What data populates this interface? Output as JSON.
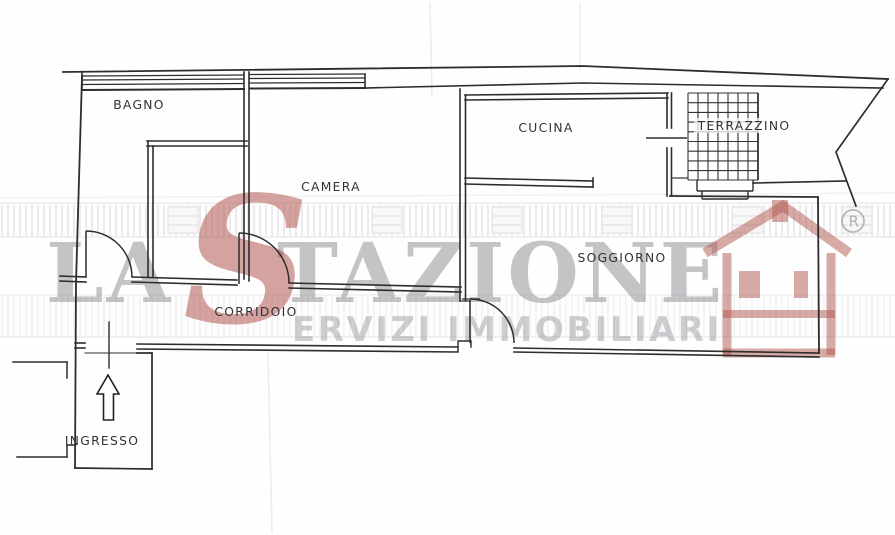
{
  "watermark": {
    "brand_first_word": "LA",
    "brand_script_s": "S",
    "brand_rest": "TAZIONE",
    "tagline": "ERVIZI IMMOBILIARI",
    "registered_mark": "®",
    "red": "#a84038",
    "gray": "#8f8f96"
  },
  "rooms": [
    {
      "name": "bagno",
      "label": "BAGNO"
    },
    {
      "name": "camera",
      "label": "CAMERA"
    },
    {
      "name": "cucina",
      "label": "CUCINA"
    },
    {
      "name": "terrazzino",
      "label": "TERRAZZINO"
    },
    {
      "name": "soggiorno",
      "label": "SOGGIORNO"
    },
    {
      "name": "corridoio",
      "label": "CORRIDOIO"
    },
    {
      "name": "ingresso",
      "label": "INGRESSO"
    }
  ],
  "symbols": {
    "entrance_arrow_direction": "up"
  }
}
